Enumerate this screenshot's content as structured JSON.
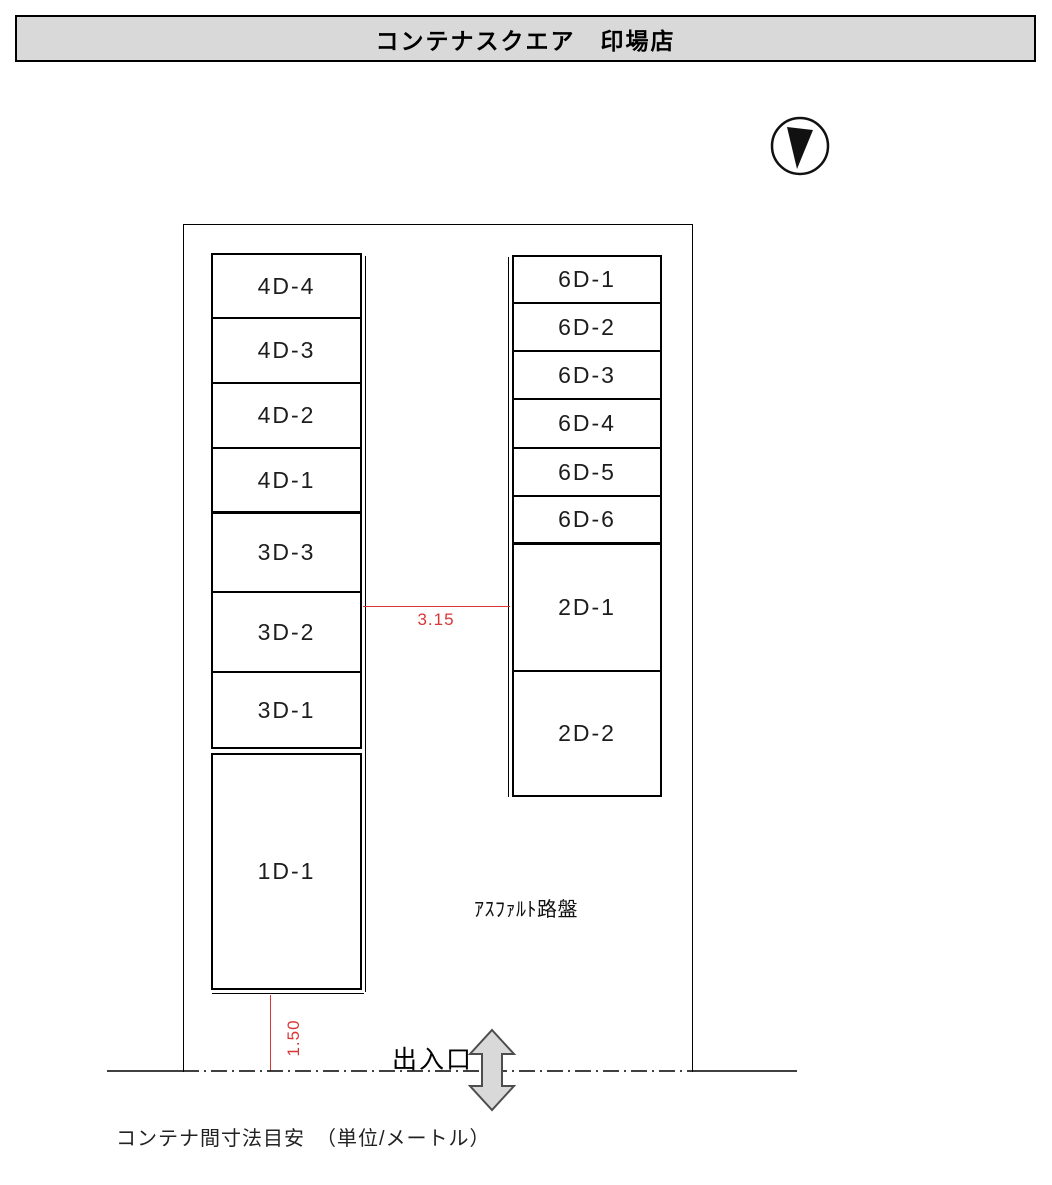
{
  "title": "コンテナスクエア　印場店",
  "site": {
    "surface_label": "ｱｽﾌｧﾙﾄ路盤",
    "entrance_label": "出入口"
  },
  "stacks": [
    {
      "id": "left-upper",
      "cells": [
        {
          "label": "4D-4",
          "h": 64
        },
        {
          "label": "4D-3",
          "h": 65
        },
        {
          "label": "4D-2",
          "h": 65
        },
        {
          "label": "4D-1",
          "h": 65,
          "thick": true
        },
        {
          "label": "3D-3",
          "h": 79
        },
        {
          "label": "3D-2",
          "h": 80
        },
        {
          "label": "3D-1",
          "h": 74
        }
      ]
    },
    {
      "id": "left-lower",
      "cells": [
        {
          "label": "1D-1",
          "h": 233
        }
      ]
    },
    {
      "id": "right",
      "cells": [
        {
          "label": "6D-1",
          "h": 47
        },
        {
          "label": "6D-2",
          "h": 48
        },
        {
          "label": "6D-3",
          "h": 48
        },
        {
          "label": "6D-4",
          "h": 49
        },
        {
          "label": "6D-5",
          "h": 48
        },
        {
          "label": "6D-6",
          "h": 48,
          "thick": true
        },
        {
          "label": "2D-1",
          "h": 127
        },
        {
          "label": "2D-2",
          "h": 123
        }
      ]
    }
  ],
  "dimensions": {
    "aisle_width": "3.15",
    "front_clearance": "1.50"
  },
  "footer_note": "コンテナ間寸法目安　（単位/メートル）",
  "icons": {
    "north_arrow": "compass-circle-with-needle-pointing-down",
    "entrance_arrow": "double-headed-vertical-arrow"
  },
  "colors": {
    "dimension_red": "#d93636",
    "header_bg": "#d9d9d9",
    "line_black": "#000000",
    "arrow_fill": "#d9d9d9",
    "arrow_stroke": "#4d4d4d"
  }
}
